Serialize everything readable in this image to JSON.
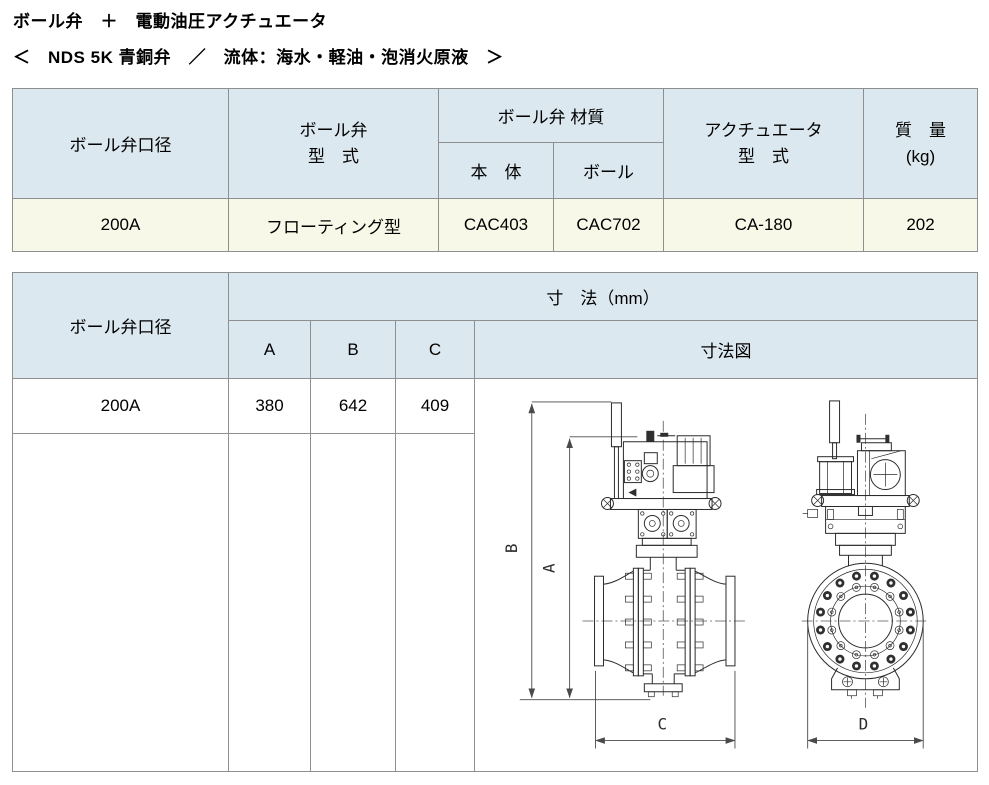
{
  "page": {
    "title": "ボール弁　＋　電動油圧アクチュエータ",
    "subtitle": "＜　NDS 5K 青銅弁　／　流体：海水・軽油・泡消火原液　＞"
  },
  "colors": {
    "header_bg": "#dce8ef",
    "data_row_bg": "#f8f8e8",
    "table_border": "#8f8f8f"
  },
  "spec_table": {
    "headers": {
      "bore": "ボール弁口径",
      "valve_type_l1": "ボール弁",
      "valve_type_l2": "型　式",
      "material_group": "ボール弁 材質",
      "material_body": "本　体",
      "material_ball": "ボール",
      "actuator_l1": "アクチュエータ",
      "actuator_l2": "型　式",
      "mass_l1": "質　量",
      "mass_l2": "(kg)"
    },
    "row": {
      "bore": "200A",
      "valve_type": "フローティング型",
      "material_body": "CAC403",
      "material_ball": "CAC702",
      "actuator_type": "CA-180",
      "mass": "202"
    }
  },
  "dim_table": {
    "headers": {
      "bore": "ボール弁口径",
      "dims_group": "寸　法（mm）",
      "col_a": "A",
      "col_b": "B",
      "col_c": "C",
      "drawing": "寸法図"
    },
    "row": {
      "bore": "200A",
      "a": "380",
      "b": "642",
      "c": "409"
    },
    "drawing_labels": {
      "a": "A",
      "b": "B",
      "c": "C",
      "d": "D"
    }
  }
}
